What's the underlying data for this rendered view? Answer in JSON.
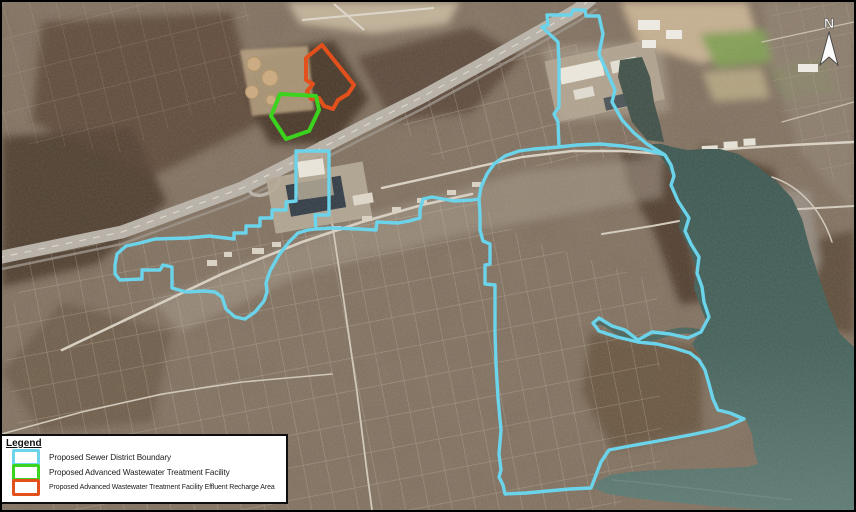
{
  "compass": {
    "north_label": "N"
  },
  "legend": {
    "title": "Legend",
    "items": [
      {
        "name": "sewer-district-boundary",
        "label": "Proposed Sewer District Boundary",
        "color": "#6BD3EA"
      },
      {
        "name": "treatment-facility",
        "label": "Proposed Advanced Wastewater Treatment Facility",
        "color": "#3CD31E"
      },
      {
        "name": "effluent-recharge-area",
        "label": "Proposed Advanced Wastewater Treatment Facility Effluent Recharge Area",
        "color": "#E4501B"
      }
    ]
  }
}
